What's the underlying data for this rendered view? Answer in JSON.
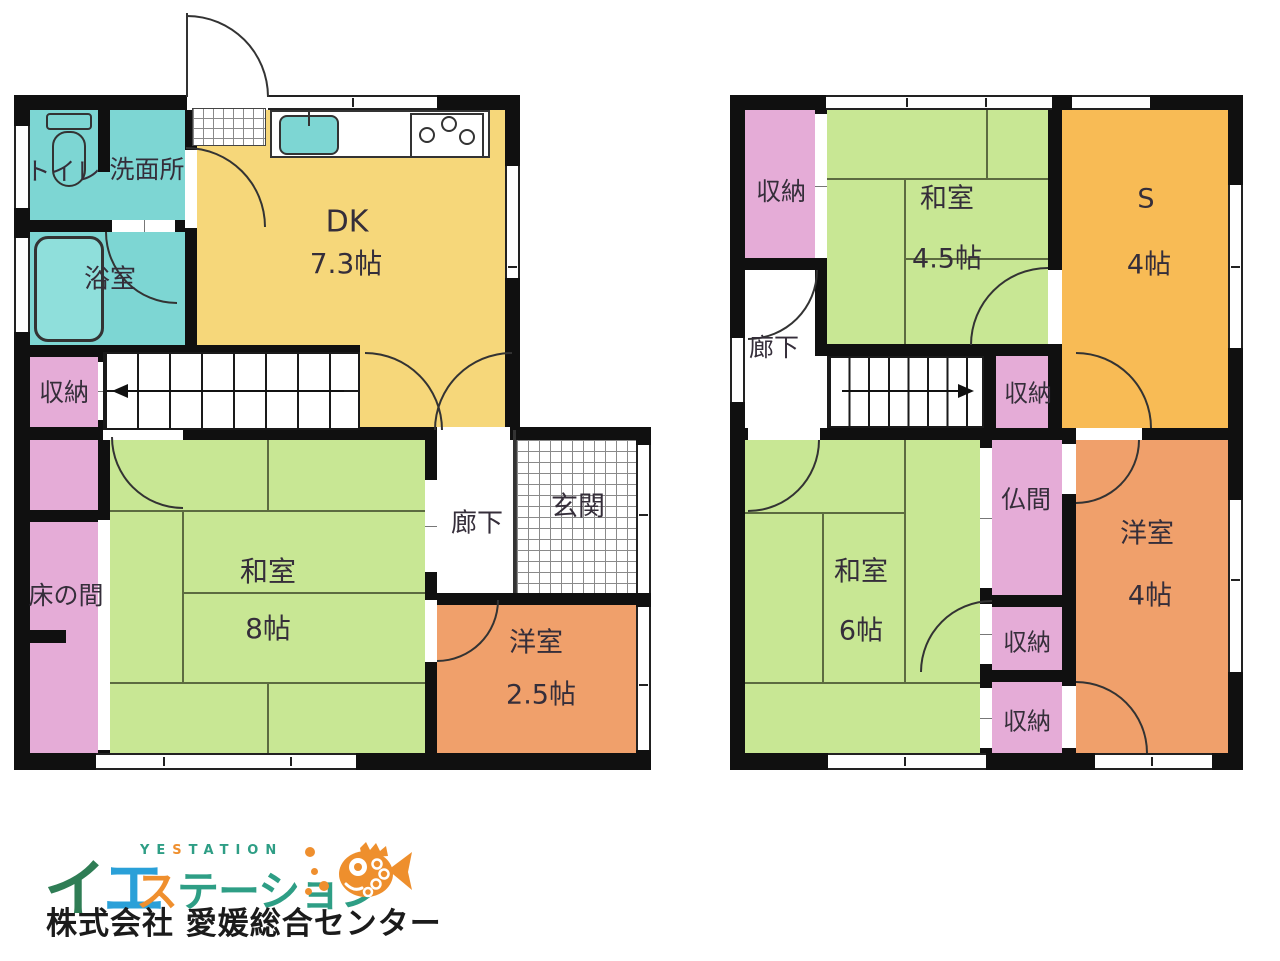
{
  "floor1": {
    "toilet": "トイレ",
    "washroom": "洗面所",
    "bathroom": "浴室",
    "dk_name": "DK",
    "dk_size": "7.3帖",
    "storage": "収納",
    "tokonoma": "床の間",
    "washitsu_name": "和室",
    "washitsu_size": "8帖",
    "corridor": "廊下",
    "entrance": "玄関",
    "youshitsu_name": "洋室",
    "youshitsu_size": "2.5帖"
  },
  "floor2": {
    "storage_top": "収納",
    "washitsu45_name": "和室",
    "washitsu45_size": "4.5帖",
    "service_name": "S",
    "service_size": "4帖",
    "corridor": "廊下",
    "storage_mid": "収納",
    "washitsu6_name": "和室",
    "washitsu6_size": "6帖",
    "butsuma": "仏間",
    "storage_r1": "収納",
    "storage_r2": "収納",
    "youshitsu_name": "洋室",
    "youshitsu_size": "4帖"
  },
  "logo": {
    "ie_i": "イ",
    "ie_e": "エ",
    "yestation_ye": "YE",
    "yestation_s": "S",
    "yestation_tation": "TATION",
    "katakana_su": "ス",
    "katakana_rest": "テーション",
    "company": "株式会社 愛媛総合センター"
  },
  "colors": {
    "tatami_green": "#c8e794",
    "dk_yellow": "#f6d77a",
    "service_amber": "#f8bb55",
    "youshitsu_orange": "#f0a06b",
    "storage_pink": "#e5acd7",
    "wet_teal": "#7dd6d3",
    "wall_black": "#101010",
    "logo_green": "#2e9e85",
    "logo_dark_green": "#2f7d55",
    "logo_blue": "#2aa0d8",
    "logo_orange": "#ef8f2e"
  }
}
